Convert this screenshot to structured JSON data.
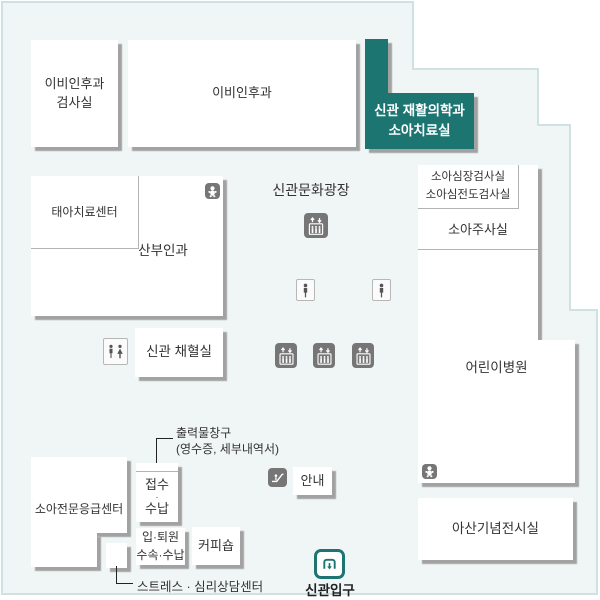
{
  "colors": {
    "teal": "#1d7572",
    "floor_fill": "#f0f6f5",
    "floor_border": "#cfe1e0",
    "box_shadow": "#a2a2a2",
    "text": "#333333",
    "icon_dark": "#767676"
  },
  "rooms": {
    "ent_exam": {
      "line1": "이비인후과",
      "line2": "검사실"
    },
    "ent": {
      "label": "이비인후과"
    },
    "rehab": {
      "line1": "신관 재활의학과",
      "line2": "소아치료실",
      "highlighted": "true"
    },
    "fetal": {
      "label": "태아치료센터"
    },
    "obgyn": {
      "label": "산부인과"
    },
    "cardiac": {
      "line1": "소아심장검사실",
      "line2": "소아심전도검사실"
    },
    "injection": {
      "label": "소아주사실"
    },
    "children": {
      "label": "어린이병원"
    },
    "blood": {
      "label": "신관 채혈실"
    },
    "memorial": {
      "label": "아산기념전시실"
    },
    "emergency": {
      "label": "소아전문응급센터"
    },
    "reception": {
      "line1": "접수",
      "dot": "·",
      "line2": "수납"
    },
    "admission": {
      "line1": "입·퇴원",
      "line2": "수속·수납"
    },
    "coffee": {
      "label": "커피숍"
    },
    "info": {
      "label": "안내"
    }
  },
  "labels": {
    "plaza": "신관문화광장",
    "printout_title": "출력물창구",
    "printout_sub": "(영수증, 세부내역서)",
    "stress": "스트레스 · 심리상담센터",
    "entrance": "신관입구"
  },
  "icons": {
    "elevator": "elevator-icon",
    "escalator": "escalator-icon",
    "restroom": "restroom-icon",
    "person": "person-icon",
    "baby": "baby-icon",
    "entrance": "entrance-icon"
  }
}
